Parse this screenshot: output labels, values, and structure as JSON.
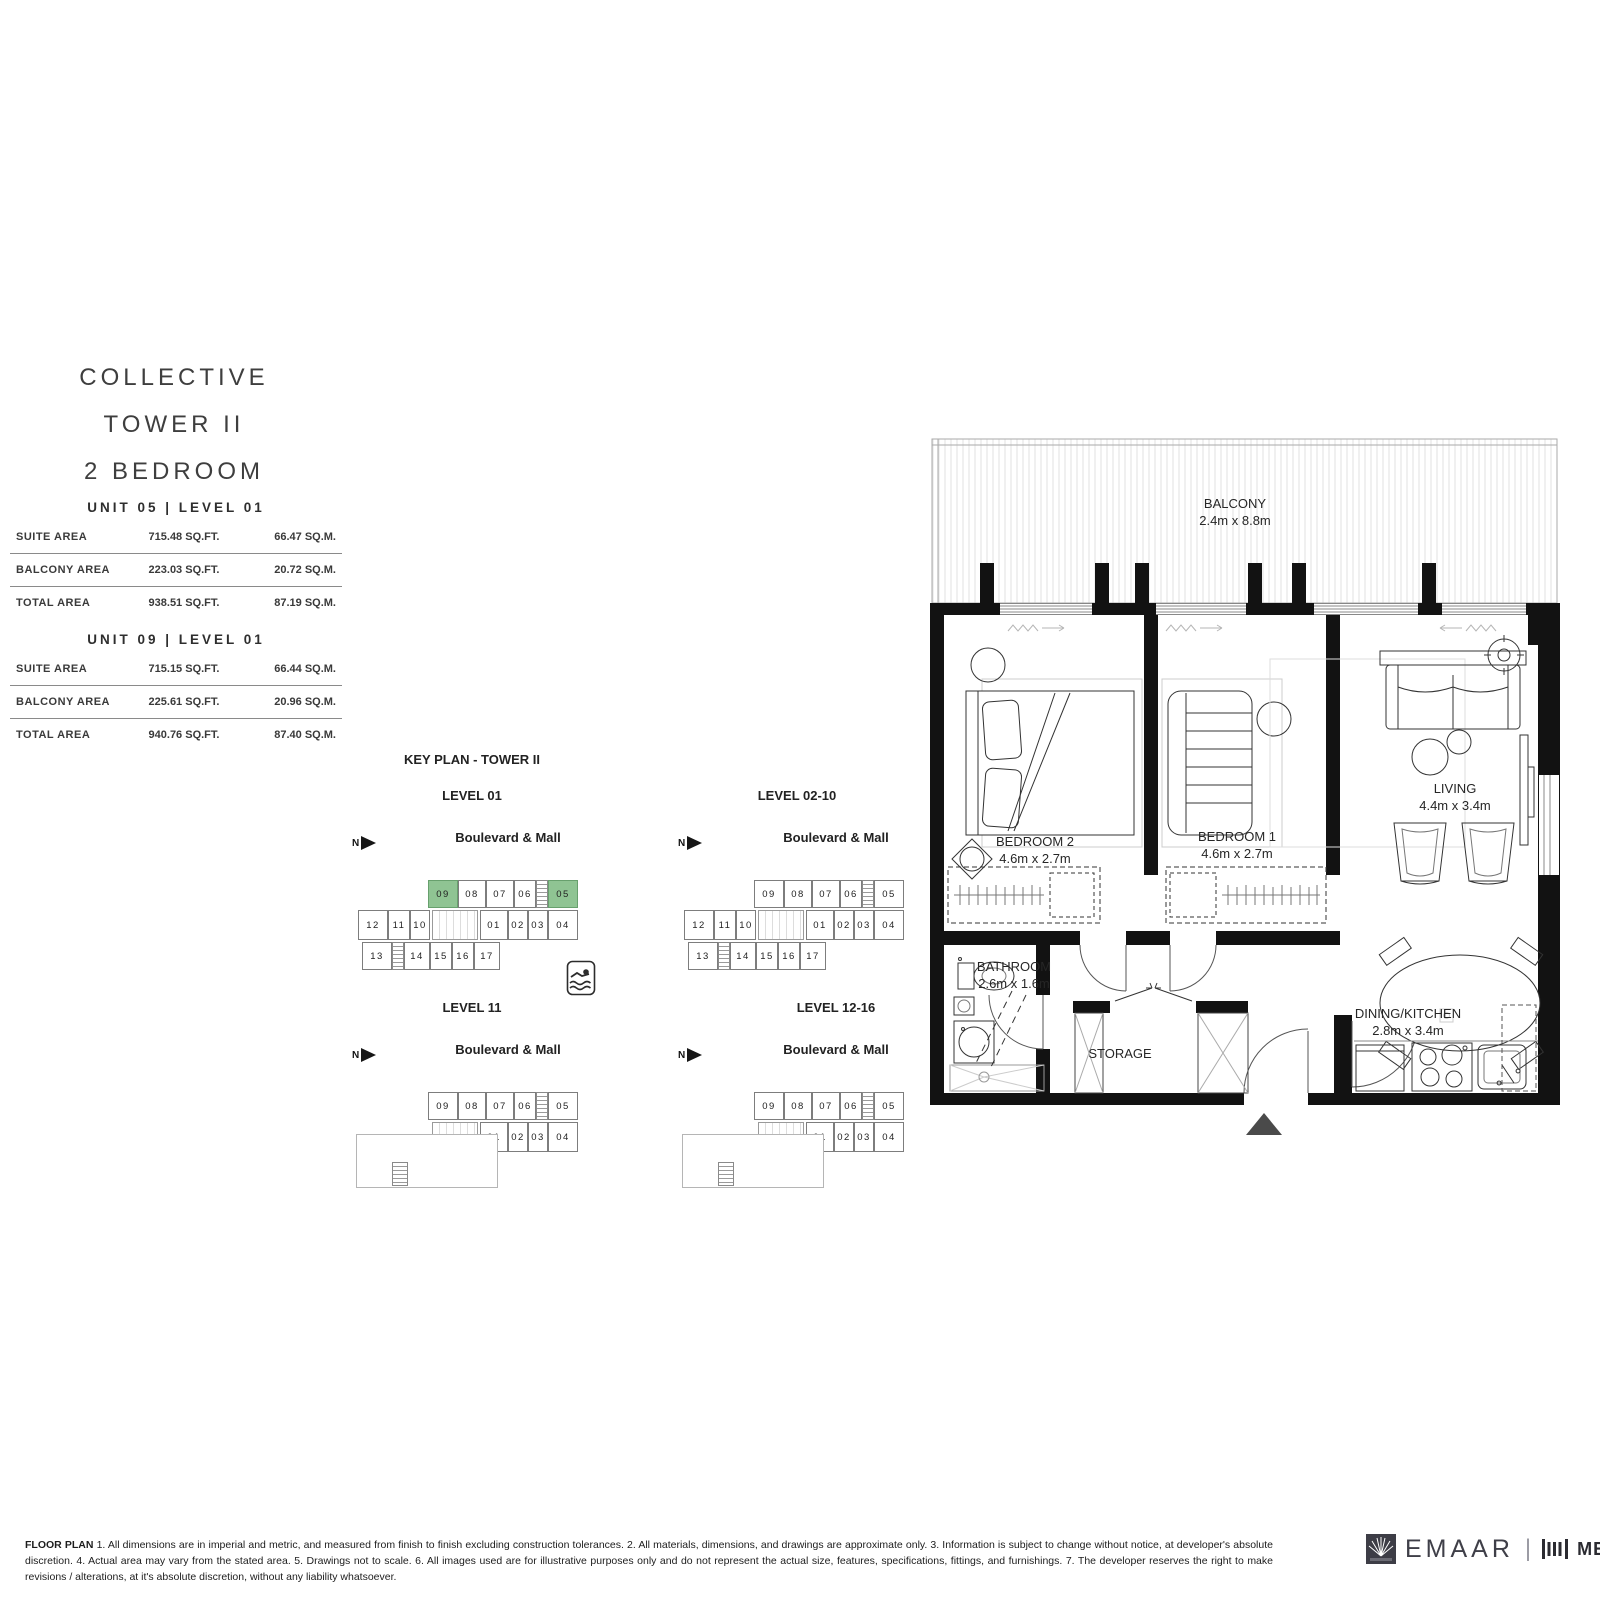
{
  "title": {
    "line1": "COLLECTIVE",
    "line2": "TOWER II",
    "line3": "2 BEDROOM"
  },
  "units": [
    {
      "header": "UNIT 05 | LEVEL 01",
      "rows": [
        {
          "label": "SUITE AREA",
          "sqft": "715.48 SQ.FT.",
          "sqm": "66.47 SQ.M."
        },
        {
          "label": "BALCONY AREA",
          "sqft": "223.03 SQ.FT.",
          "sqm": "20.72 SQ.M."
        },
        {
          "label": "TOTAL AREA",
          "sqft": "938.51 SQ.FT.",
          "sqm": "87.19 SQ.M."
        }
      ]
    },
    {
      "header": "UNIT 09 | LEVEL 01",
      "rows": [
        {
          "label": "SUITE AREA",
          "sqft": "715.15 SQ.FT.",
          "sqm": "66.44 SQ.M."
        },
        {
          "label": "BALCONY AREA",
          "sqft": "225.61 SQ.FT.",
          "sqm": "20.96 SQ.M."
        },
        {
          "label": "TOTAL AREA",
          "sqft": "940.76 SQ.FT.",
          "sqm": "87.40 SQ.M."
        }
      ]
    }
  ],
  "keyplan": {
    "title": "KEY PLAN - TOWER II",
    "north_label": "N",
    "pool_icon": "swimmer-icon",
    "units": {
      "top": [
        "09",
        "08",
        "07",
        "06",
        "05"
      ],
      "mid_left": [
        "12",
        "11",
        "10"
      ],
      "mid_right": [
        "01",
        "02",
        "03",
        "04"
      ],
      "bottom": [
        "13",
        "14",
        "15",
        "16",
        "17"
      ]
    },
    "levels": [
      {
        "label": "LEVEL 01",
        "street": "Boulevard & Mall",
        "type": "full",
        "highlight": [
          "09",
          "05"
        ]
      },
      {
        "label": "LEVEL 02-10",
        "street": "Boulevard & Mall",
        "type": "full",
        "highlight": []
      },
      {
        "label": "LEVEL 11",
        "street": "Boulevard & Mall",
        "type": "terrace",
        "highlight": []
      },
      {
        "label": "LEVEL 12-16",
        "street": "Boulevard & Mall",
        "type": "terrace",
        "highlight": []
      }
    ],
    "highlight_color": "#8fc493"
  },
  "floorplan": {
    "balcony": {
      "name": "BALCONY",
      "dim": "2.4m x 8.8m"
    },
    "bedroom2": {
      "name": "BEDROOM 2",
      "dim": "4.6m x 2.7m"
    },
    "bedroom1": {
      "name": "BEDROOM 1",
      "dim": "4.6m x 2.7m"
    },
    "living": {
      "name": "LIVING",
      "dim": "4.4m x 3.4m"
    },
    "bathroom": {
      "name": "BATHROOM",
      "dim": "2.6m x 1.6m"
    },
    "storage": {
      "name": "STORAGE"
    },
    "dining": {
      "name": "DINING/KITCHEN",
      "dim": "2.8m x 3.4m"
    }
  },
  "footer": {
    "disclaimer_label": "FLOOR PLAN",
    "disclaimer": " 1. All dimensions are in imperial and metric, and measured from finish to finish excluding construction tolerances. 2. All materials, dimensions, and drawings are approximate only. 3. Information is subject to change without notice, at developer's absolute discretion. 4. Actual area may vary from the stated area. 5. Drawings not to scale. 6. All images used are for illustrative purposes only and do not represent the actual size, features, specifications, fittings, and furnishings. 7. The developer reserves the right to make revisions / alterations, at it's absolute discretion, without any liability whatsoever.",
    "brand1": "EMAAR",
    "brand2": "MERAAS"
  }
}
